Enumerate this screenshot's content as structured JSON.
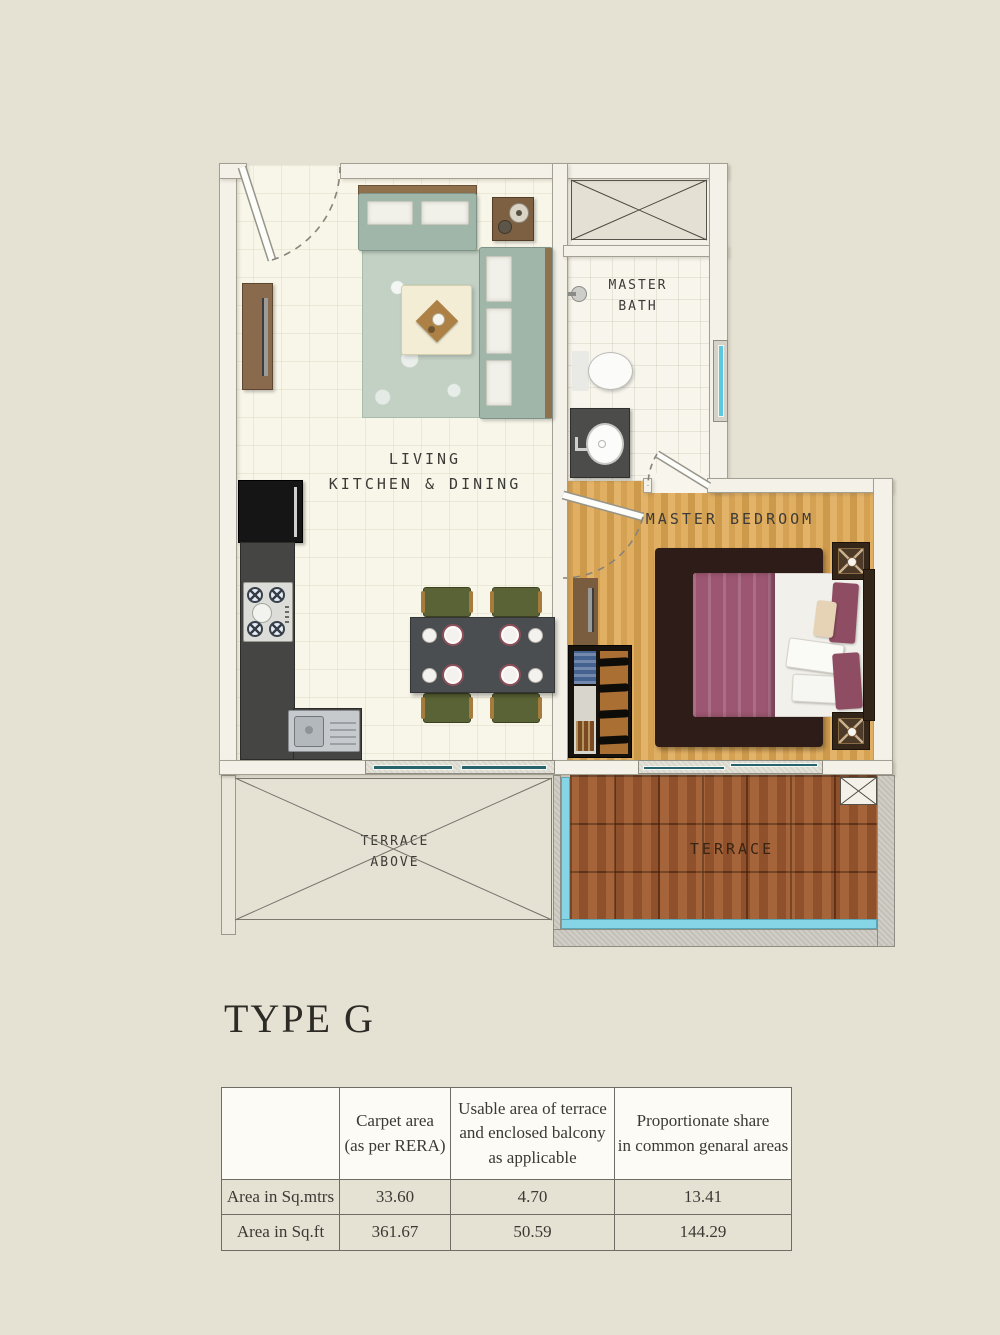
{
  "page": {
    "title": "TYPE G",
    "background_color": "#e5e2d4"
  },
  "floor_plan": {
    "labels": {
      "living_line1": "LIVING",
      "living_line2": "KITCHEN & DINING",
      "master_bath_line1": "MASTER",
      "master_bath_line2": "BATH",
      "master_bedroom": "MASTER BEDROOM",
      "terrace_above_line1": "TERRACE",
      "terrace_above_line2": "ABOVE",
      "terrace": "TERRACE"
    },
    "colors": {
      "page_background": "#e5e2d4",
      "wall": "#f3f1e8",
      "living_floor": "#f8f6e8",
      "bedroom_wood": "#dcab5e",
      "terrace_wood": "#9b5830",
      "bed_blanket_maroon": "#9d5671",
      "sofa_sage": "#a0b6a8",
      "window_glass_teal": "#26636c",
      "railing_cyan": "#85d5e6",
      "kitchen_counter": "#454543"
    }
  },
  "area_table": {
    "header": {
      "col0": "",
      "col1": [
        "Carpet area",
        "(as per RERA)"
      ],
      "col2": [
        "Usable area of terrace",
        "and enclosed balcony",
        "as applicable"
      ],
      "col3": [
        "Proportionate share",
        "in common genaral areas"
      ]
    },
    "rows": [
      {
        "label": "Area in Sq.mtrs",
        "carpet": "33.60",
        "terrace": "4.70",
        "common": "13.41"
      },
      {
        "label": "Area in Sq.ft",
        "carpet": "361.67",
        "terrace": "50.59",
        "common": "144.29"
      }
    ]
  }
}
